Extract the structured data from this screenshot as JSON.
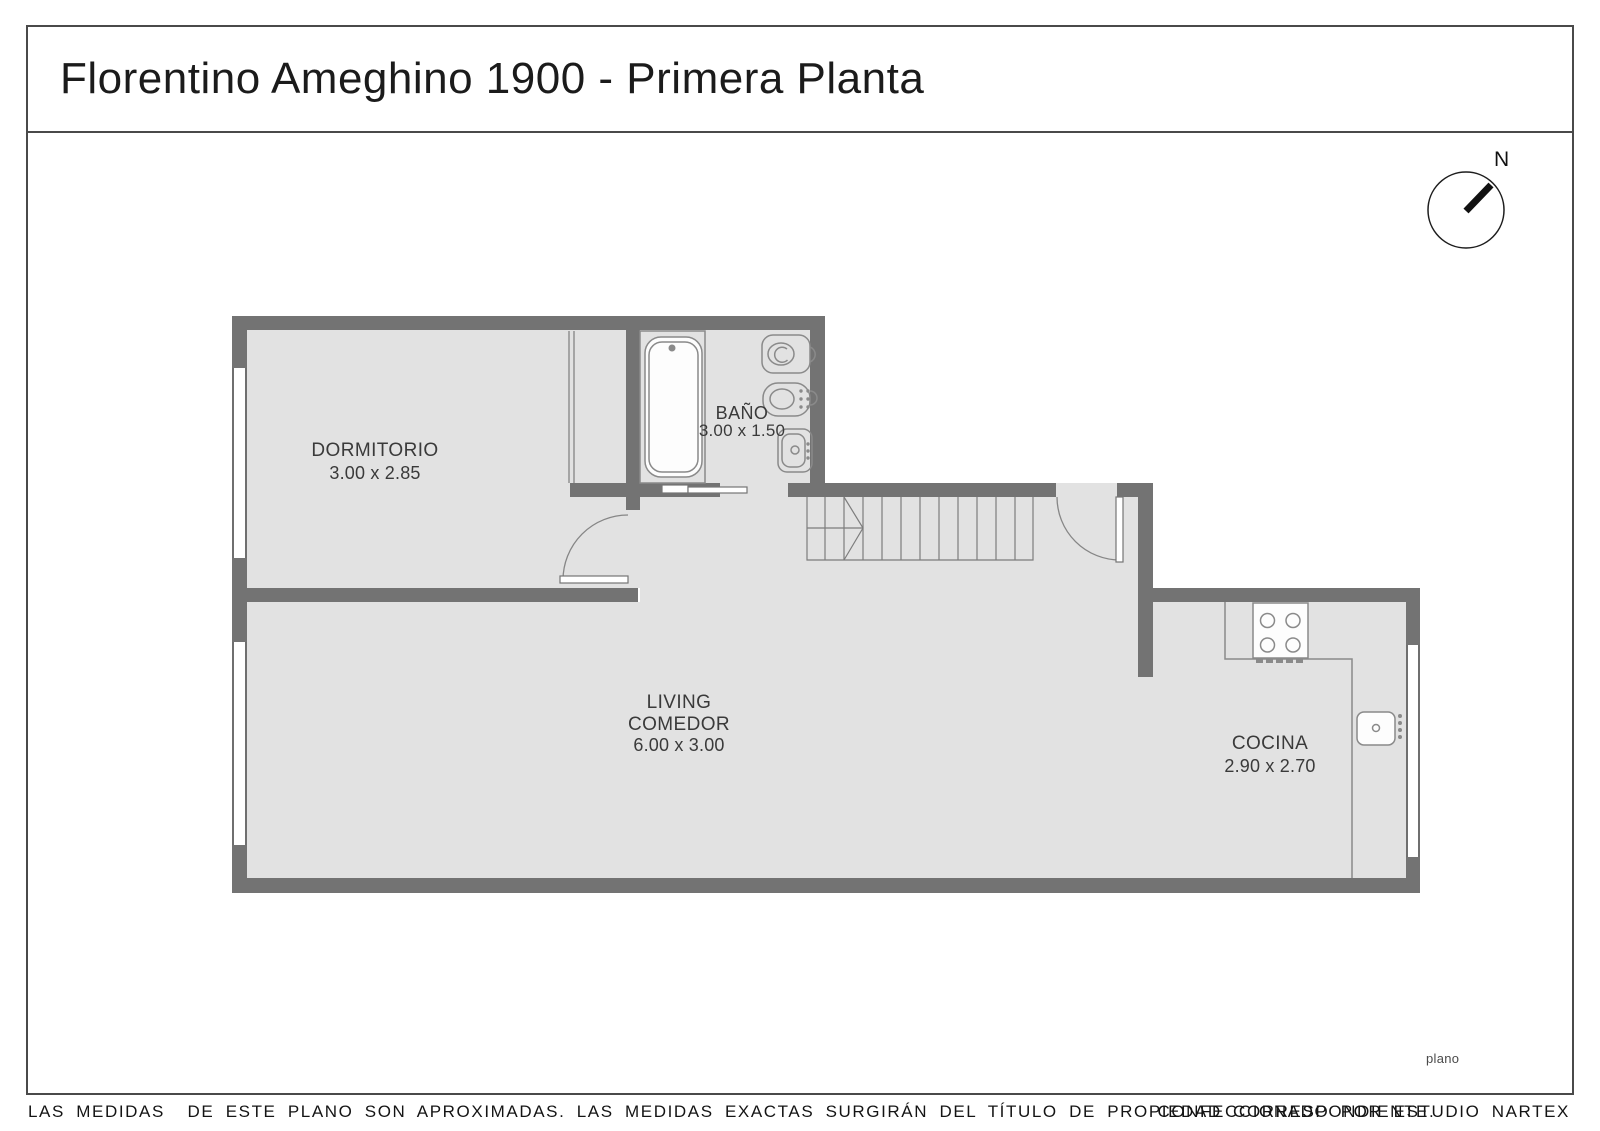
{
  "header": {
    "title": "Florentino Ameghino 1900 - Primera Planta"
  },
  "compass": {
    "label": "N"
  },
  "rooms": {
    "dormitorio": {
      "name": "DORMITORIO",
      "dims": "3.00 x 2.85"
    },
    "bano": {
      "name": "BAÑO",
      "dims": "3.00 x 1.50"
    },
    "living": {
      "name_line1": "LIVING",
      "name_line2": "COMEDOR",
      "dims": "6.00 x 3.00"
    },
    "cocina": {
      "name": "COCINA",
      "dims": "2.90 x 2.70"
    }
  },
  "watermark": "plano",
  "footer": {
    "disclaimer": "LAS MEDIDAS  DE ESTE PLANO SON APROXIMADAS. LAS MEDIDAS EXACTAS SURGIRÁN DEL TÍTULO DE PROPIEDAD CORRESPONDIENTE.",
    "credit": "CONFECCIONADO POR ESTUDIO NARTEX"
  },
  "colors": {
    "wall": "#737373",
    "floor": "#e2e2e2",
    "fixture_line": "#8a8a8a",
    "border": "#4a4a4a",
    "label_text": "#3a3a3a"
  }
}
